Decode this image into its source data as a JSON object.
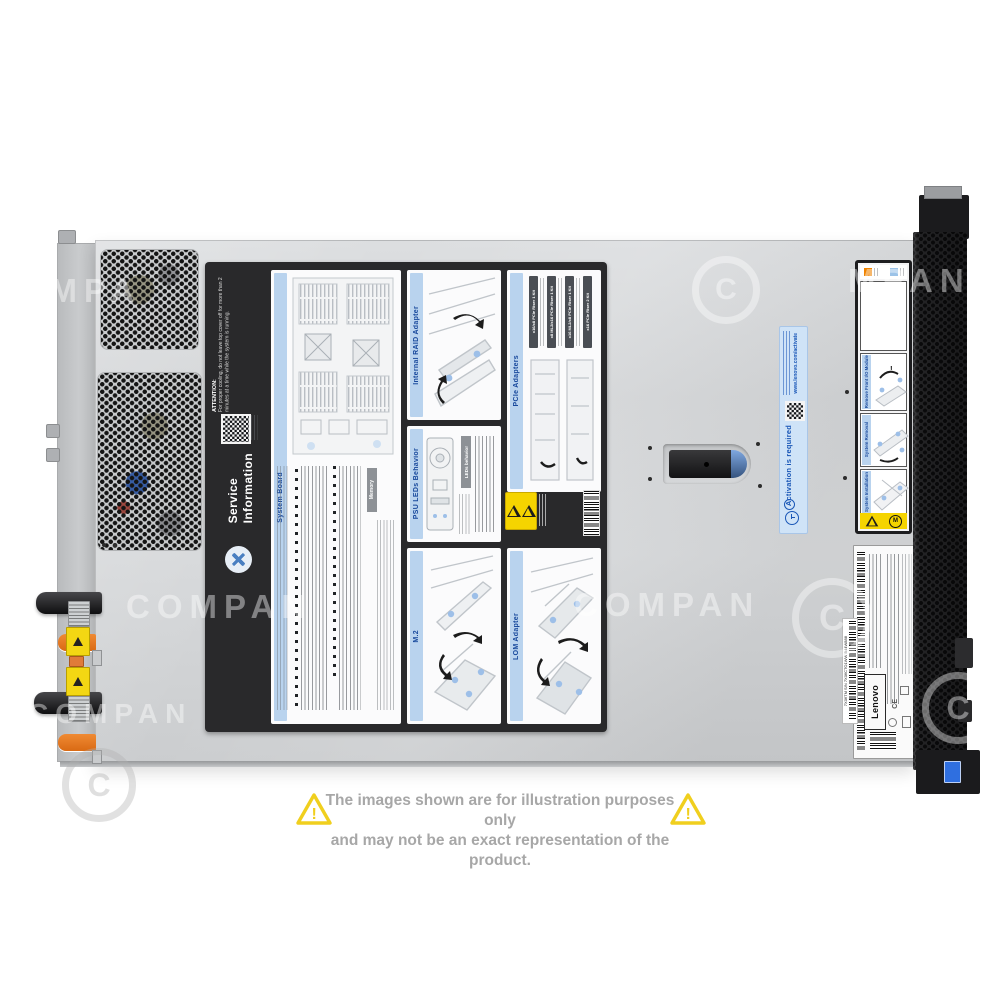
{
  "watermark": {
    "text": "COMPAN",
    "partial_left": "COMPA",
    "partial_right": "MPAN",
    "symbol": "C"
  },
  "disclaimer": {
    "line1": "The images shown are for illustration purposes only",
    "line2": "and may not be an exact representation of the product.",
    "warning_mark": "!"
  },
  "service_label": {
    "title_line1": "Service",
    "title_line2": "Information",
    "attention_heading": "ATTENTION:",
    "attention_body": "For proper cooling, do not leave top cover off for more than 2 minutes at a time while the system is running.",
    "panels": {
      "system_board": "System Board",
      "memory": "Memory",
      "internal_raid": "Internal RAID Adapter",
      "psu_leds": "PSU LEDs Behavior",
      "leds_behavior": "LEDs behavior",
      "pcie_adapters": "PCIe Adapters",
      "m2": "M.2",
      "lom": "LOM Adapter"
    },
    "pcie_risers": [
      "x16/x8 PCIe Riser 1 Kit",
      "x8 ML2/x16 PCIe Riser 1 Kit",
      "x16 ML2/x8 PCIe Riser 1 Kit",
      "x16 PCIe Riser 2 Kit"
    ]
  },
  "activation_sticker": {
    "title": "Activation is required",
    "url": "www.lenovo.com/activate"
  },
  "front_label_strip": {
    "panel1": "Remove Front I/O Module",
    "panel2": "System Removal",
    "panel3": "System Installation"
  },
  "product_label": {
    "brand": "Lenovo",
    "cert": "CE",
    "serial": "7X06TM S/N 7X06CTO1WW B44W888"
  },
  "colors": {
    "chassis": "#d6d8da",
    "label_bg": "#29292b",
    "band_blue": "#b9d3ee",
    "title_blue": "#17489c",
    "activation_blue": "#1a57b7",
    "warning_yellow": "#f5d400",
    "orange_tab": "#e8731f",
    "badge_blue": "#2f6fe0"
  }
}
